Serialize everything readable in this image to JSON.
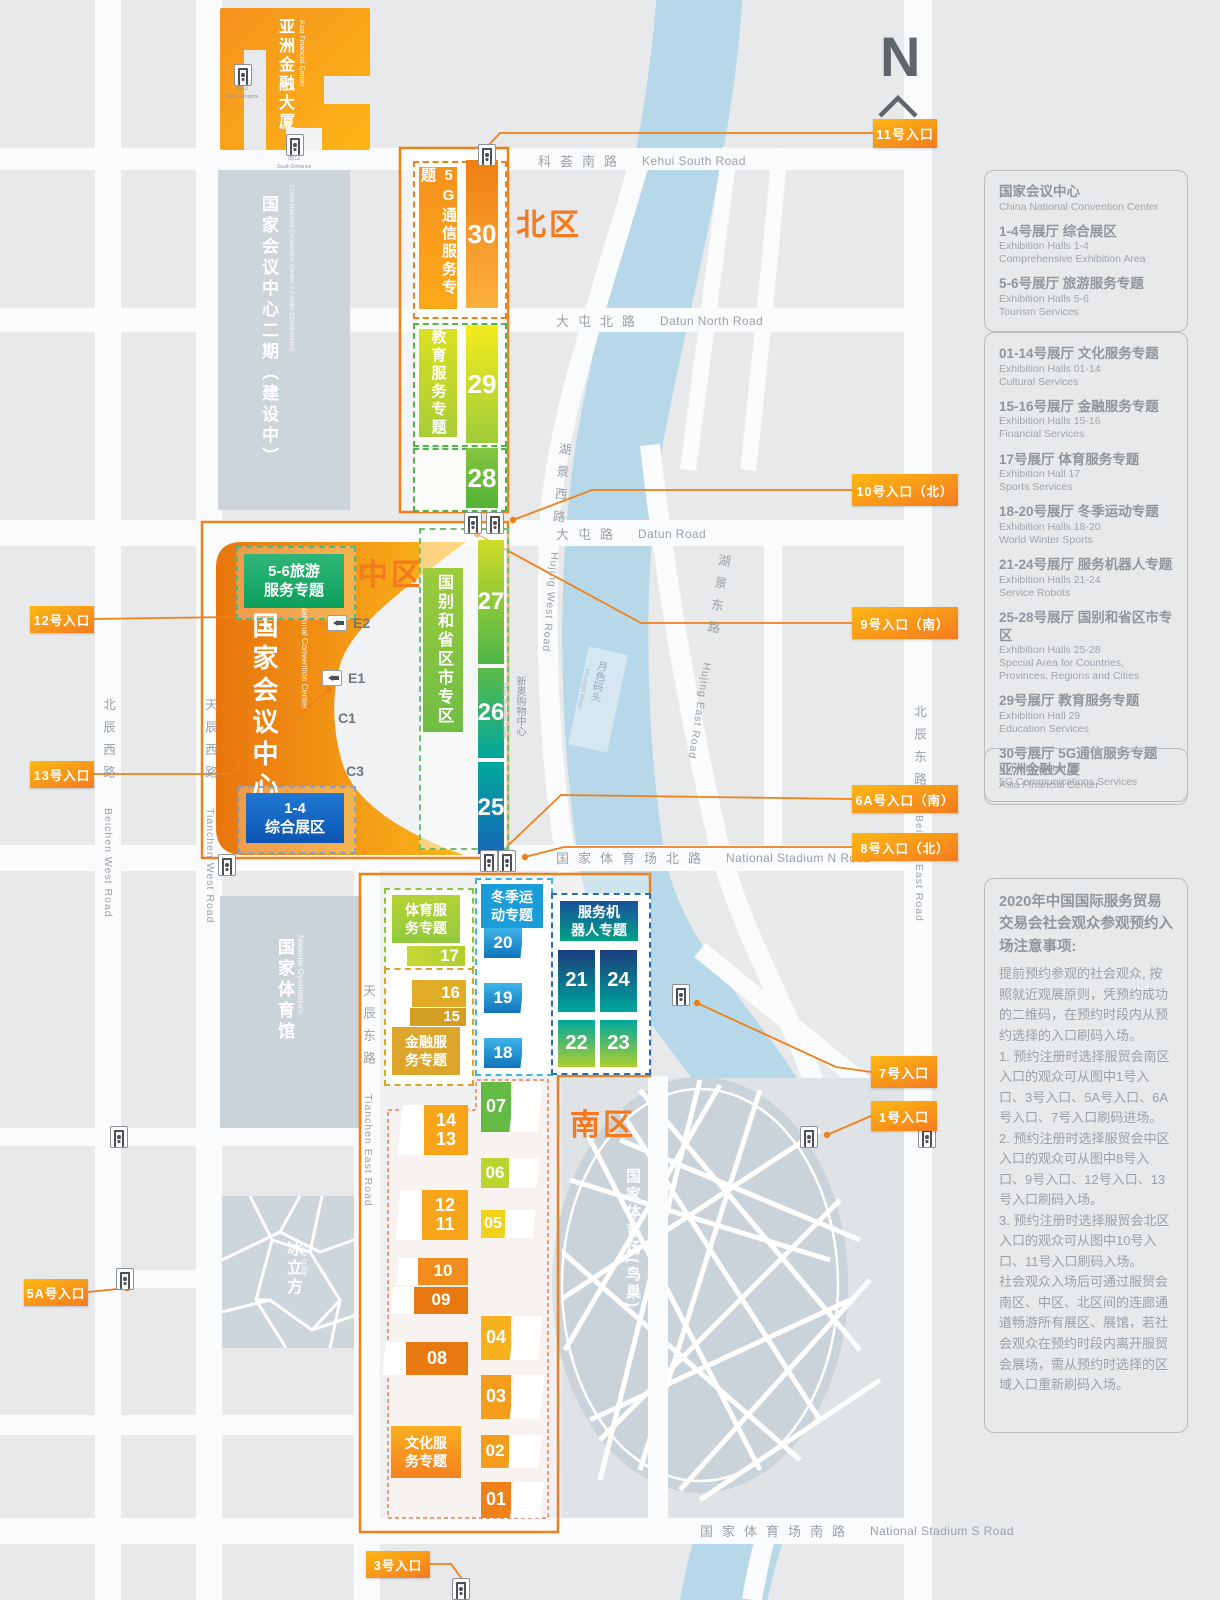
{
  "colors": {
    "accent": "#F08019",
    "badge_from": "#FDB813",
    "badge_to": "#F47B20",
    "river": "#B7D8E8"
  },
  "compass": {
    "n": "N"
  },
  "zones": {
    "north": "北区",
    "middle": "中区",
    "south": "南区"
  },
  "buildings": {
    "afc": {
      "zh": "亚洲金融大厦",
      "en": "Asia Financial Center",
      "west_zh": "西口",
      "west_en": "West Entrance",
      "south_zh": "南口",
      "south_en": "South Entrance"
    },
    "cncc2": {
      "zh": "国家会议中心二期（建设中）",
      "en": "China National Convention Center 2 (Under Construction)"
    },
    "cncc": {
      "zh": "国家会议中心",
      "en": "China National Convention Center"
    },
    "gym": {
      "zh": "国家体育馆",
      "en": "National Gymnasium"
    },
    "stadium": {
      "zh": "国家体育场(鸟巢)",
      "en": "National Stadium (Bird's Nest)"
    },
    "icecube": {
      "zh": "冰立方",
      "en": "Ice cube"
    },
    "xinao": {
      "zh": "新奥购物中心",
      "en": "Xinao Shopping Center"
    },
    "wharf": {
      "zh": "月色码头",
      "en": "Moonlight Wharf"
    }
  },
  "area_labels": {
    "g5": "5G通信服务专题",
    "edu": "教育服务专题",
    "country": "国别和省区市专区",
    "tourism": "5-6旅游\n服务专题",
    "comp": "1-4\n综合展区",
    "sports": "体育服\n务专题",
    "finance": "金融服\n务专题",
    "winter": "冬季运\n动专题",
    "robots": "服务机\n器人专题",
    "culture": "文化服\n务专题"
  },
  "halls": {
    "h30": "30",
    "h29": "29",
    "h28": "28",
    "h27": "27",
    "h26": "26",
    "h25": "25",
    "h17": "17",
    "h16": "16",
    "h15": "15",
    "h20": "20",
    "h19": "19",
    "h18": "18",
    "h21": "21",
    "h24": "24",
    "h22": "22",
    "h23": "23",
    "h1413": "14\n13",
    "h1211": "12\n11",
    "h10": "10",
    "h09": "09",
    "h08": "08",
    "h07": "07",
    "h06": "06",
    "h05": "05",
    "h04": "04",
    "h03": "03",
    "h02": "02",
    "h01": "01"
  },
  "gates": {
    "e2": "E2",
    "e1": "E1",
    "c1": "C1",
    "c3": "C3"
  },
  "entrances": {
    "n11": "11号入口",
    "n10": "10号入口（北）",
    "n9": "9号入口（南）",
    "n6a": "6A号入口（南）",
    "n8": "8号入口（北）",
    "n7": "7号入口",
    "n1": "1号入口",
    "n12": "12号入口",
    "n13": "13号入口",
    "n5a": "5A号入口",
    "n3": "3号入口"
  },
  "roads": {
    "kehui_zh": "科荟南路",
    "kehui_en": "Kehui South Road",
    "datun_n_zh": "大屯北路",
    "datun_n_en": "Datun North Road",
    "datun_zh": "大屯路",
    "datun_en": "Datun Road",
    "nsn_zh": "国家体育场北路",
    "nsn_en": "National Stadium N Road",
    "nss_zh": "国家体育场南路",
    "nss_en": "National Stadium S Road",
    "beichen_w_zh": "北辰西路",
    "beichen_w_en": "Beichen West Road",
    "tianchen_w_zh": "天辰西路",
    "tianchen_w_en": "Tianchen West Road",
    "tianchen_e_zh": "天辰东路",
    "tianchen_e_en": "Tianchen East Road",
    "beichen_e_zh": "北辰东路",
    "beichen_e_en": "Beichen East Road",
    "hujing_w_zh": "湖景西路",
    "hujing_w_en": "Hujing West Road",
    "hujing_e_zh": "湖景东路",
    "hujing_e_en": "Hujing East Road"
  },
  "legend": {
    "box1": {
      "title_zh": "国家会议中心",
      "title_en": "China National Convention Center",
      "items": [
        {
          "zh": "1-4号展厅 综合展区",
          "en1": "Exhibition Halls 1-4",
          "en2": "Comprehensive Exhibition Area"
        },
        {
          "zh": "5-6号展厅 旅游服务专题",
          "en1": "Exhibition Halls 5-6",
          "en2": "Tourism Services"
        }
      ]
    },
    "box2": {
      "items": [
        {
          "zh": "01-14号展厅 文化服务专题",
          "en1": "Exhibition Halls 01-14",
          "en2": "Cultural Services"
        },
        {
          "zh": "15-16号展厅 金融服务专题",
          "en1": "Exhibition Halls 15-16",
          "en2": "Financial Services"
        },
        {
          "zh": "17号展厅 体育服务专题",
          "en1": "Exhibition Hall 17",
          "en2": "Sports Services"
        },
        {
          "zh": "18-20号展厅 冬季运动专题",
          "en1": "Exhibition Halls 18-20",
          "en2": "World Winter Sports"
        },
        {
          "zh": "21-24号展厅 服务机器人专题",
          "en1": "Exhibition Halls 21-24",
          "en2": "Service Robots"
        },
        {
          "zh": "25-28号展厅 国别和省区市专区",
          "en1": "Exhibition Halls 25-28",
          "en2": "Special Area for Countries, Provinces, Regions and Cities"
        },
        {
          "zh": "29号展厅 教育服务专题",
          "en1": "Exhibition Hall 29",
          "en2": "Education Services"
        },
        {
          "zh": "30号展厅 5G通信服务专题",
          "en1": "Exhibition Hall 30",
          "en2": "5G Communications Services"
        }
      ]
    },
    "box3": {
      "zh": "亚洲金融大厦",
      "en": "Asia Financial Center"
    }
  },
  "notice": {
    "title": "2020年中国国际服务贸易交易会社会观众参观预约入场注意事项:",
    "p1": "提前预约参观的社会观众, 按照就近观展原则，凭预约成功的二维码，在预约时段内从预约选择的入口刷码入场。",
    "p2": "1. 预约注册时选择服贸会南区入口的观众可从图中1号入口、3号入口、5A号入口、6A号入口、7号入口刷码进场。",
    "p3": "2. 预约注册时选择服贸会中区入口的观众可从图中8号入口、9号入口、12号入口、13号入口刷码入场。",
    "p4": "3. 预约注册时选择服贸会北区入口的观众可从图中10号入口、11号入口刷码入场。",
    "p5": "社会观众入场后可通过服贸会南区、中区、北区间的连廊通道畅游所有展区、展馆，若社会观众在预约时段内离开服贸会展场，需从预约时选择的区域入口重新刷码入场。"
  }
}
